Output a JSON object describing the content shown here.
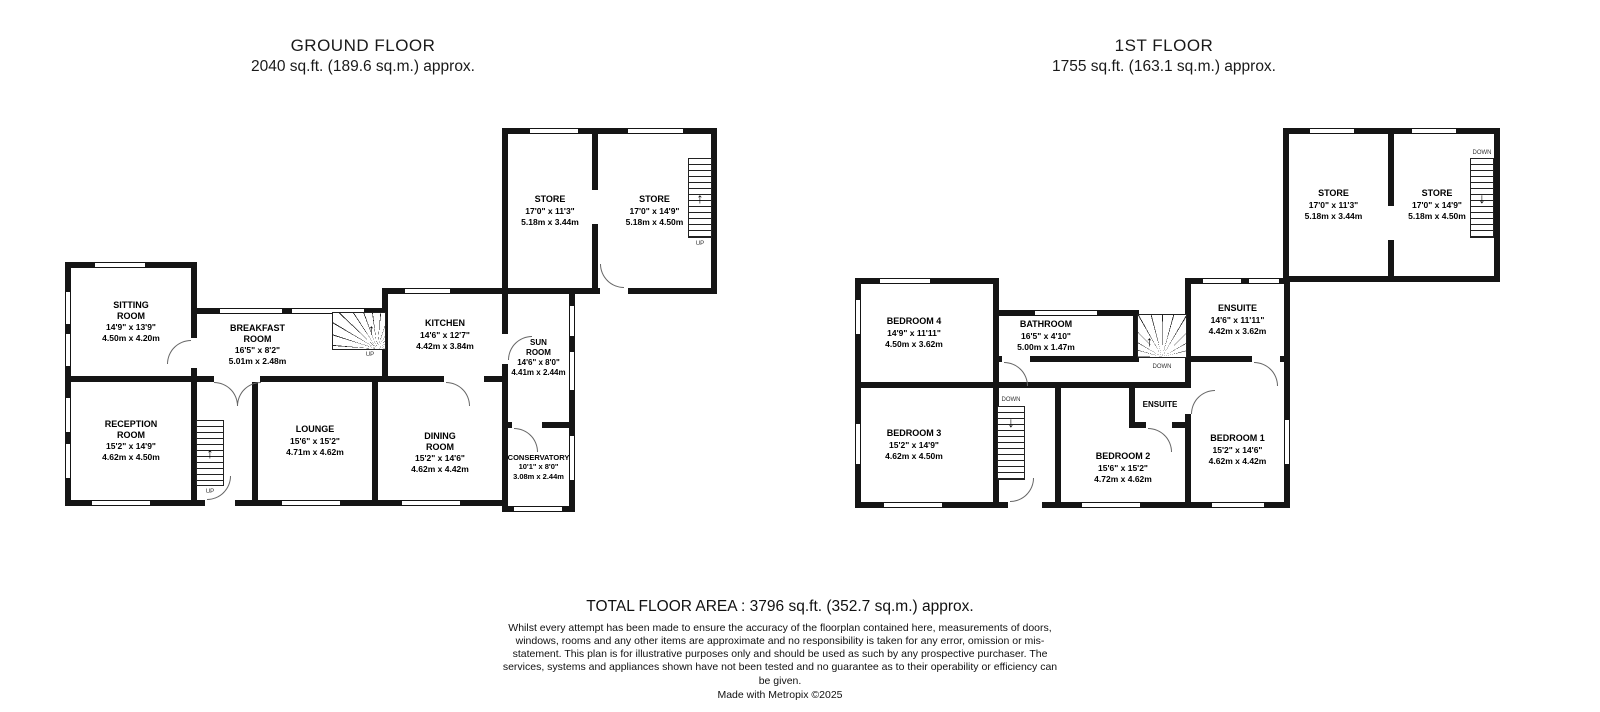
{
  "floors": [
    {
      "title": "GROUND FLOOR",
      "subtitle": "2040 sq.ft. (189.6 sq.m.) approx.",
      "rooms": [
        {
          "name": "STORE",
          "ft": "17'0\" x 11'3\"",
          "m": "5.18m x 3.44m"
        },
        {
          "name": "STORE",
          "ft": "17'0\" x 14'9\"",
          "m": "5.18m x 4.50m"
        },
        {
          "name": "SITTING\nROOM",
          "ft": "14'9\" x 13'9\"",
          "m": "4.50m x 4.20m"
        },
        {
          "name": "BREAKFAST\nROOM",
          "ft": "16'5\" x 8'2\"",
          "m": "5.01m x 2.48m"
        },
        {
          "name": "KITCHEN",
          "ft": "14'6\" x 12'7\"",
          "m": "4.42m x 3.84m"
        },
        {
          "name": "SUN\nROOM",
          "ft": "14'6\" x 8'0\"",
          "m": "4.41m x 2.44m"
        },
        {
          "name": "RECEPTION\nROOM",
          "ft": "15'2\" x 14'9\"",
          "m": "4.62m x 4.50m"
        },
        {
          "name": "LOUNGE",
          "ft": "15'6\" x 15'2\"",
          "m": "4.71m x 4.62m"
        },
        {
          "name": "DINING\nROOM",
          "ft": "15'2\" x 14'6\"",
          "m": "4.62m x 4.42m"
        },
        {
          "name": "CONSERVATORY",
          "ft": "10'1\" x 8'0\"",
          "m": "3.08m x 2.44m"
        }
      ]
    },
    {
      "title": "1ST FLOOR",
      "subtitle": "1755 sq.ft. (163.1 sq.m.) approx.",
      "rooms": [
        {
          "name": "STORE",
          "ft": "17'0\" x 11'3\"",
          "m": "5.18m x 3.44m"
        },
        {
          "name": "STORE",
          "ft": "17'0\" x 14'9\"",
          "m": "5.18m x 4.50m"
        },
        {
          "name": "BEDROOM 4",
          "ft": "14'9\" x 11'11\"",
          "m": "4.50m x 3.62m"
        },
        {
          "name": "BATHROOM",
          "ft": "16'5\" x 4'10\"",
          "m": "5.00m x 1.47m"
        },
        {
          "name": "ENSUITE",
          "ft": "14'6\" x 11'11\"",
          "m": "4.42m x 3.62m"
        },
        {
          "name": "BEDROOM 3",
          "ft": "15'2\" x 14'9\"",
          "m": "4.62m x 4.50m"
        },
        {
          "name": "BEDROOM 2",
          "ft": "15'6\" x 15'2\"",
          "m": "4.72m x 4.62m"
        },
        {
          "name": "ENSUITE",
          "ft": "",
          "m": ""
        },
        {
          "name": "BEDROOM 1",
          "ft": "15'2\" x 14'6\"",
          "m": "4.62m x 4.42m"
        }
      ]
    }
  ],
  "labels": {
    "up": "UP",
    "down": "DOWN"
  },
  "icons": {
    "up_arrow": "↑",
    "down_arrow": "↓"
  },
  "footer": {
    "total": "TOTAL FLOOR AREA : 3796 sq.ft. (352.7 sq.m.) approx.",
    "disclaimer": "Whilst every attempt has been made to ensure the accuracy of the floorplan contained here, measurements of doors, windows, rooms and any other items are approximate and no responsibility is taken for any error, omission or mis-statement. This plan is for illustrative purposes only and should be used as such by any prospective purchaser. The services, systems and appliances shown have not been tested and no guarantee as to their operability or efficiency can be given.",
    "credit": "Made with Metropix ©2025"
  }
}
